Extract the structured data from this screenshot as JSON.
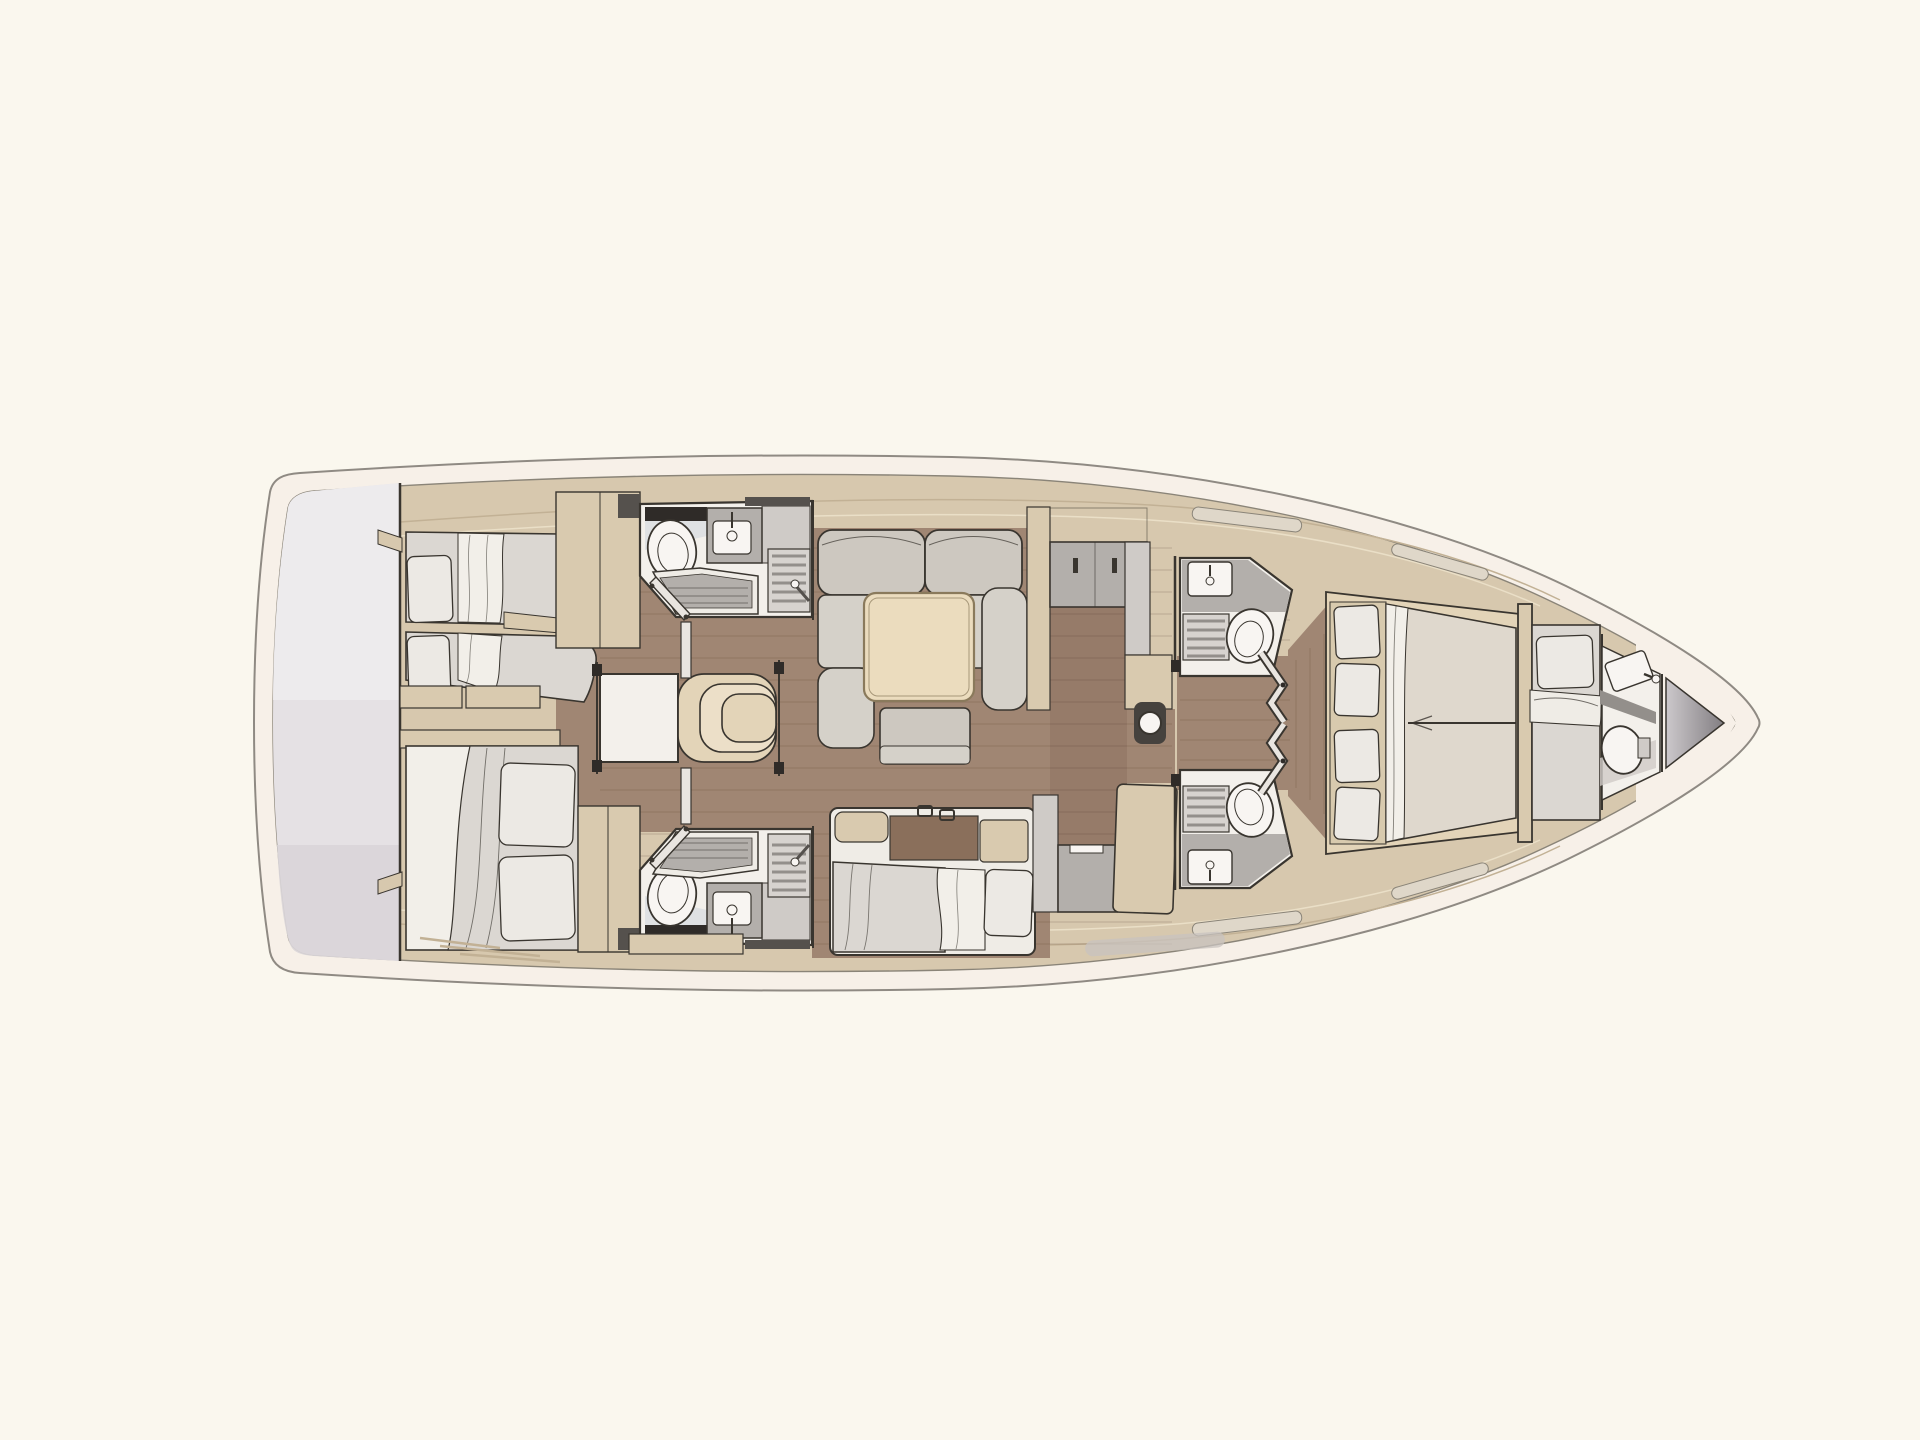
{
  "title": "Sailing yacht interior layout plan — top view (3-cabin / 4-head version)",
  "colors": {
    "bg": "#FAF7EE",
    "hullBand": "#F7F0E8",
    "hullLine": "#8F8A83",
    "deck": "#D7C8AE",
    "deckLine1": "#C2B195",
    "deckLine2": "#EADFC7",
    "deckEdge": "#8A8478",
    "floor": "#A08673",
    "plank": "#5A3E2D",
    "galleyTint": "#50321E",
    "transom": "#E5E1E4",
    "transomHi": "#EFECEE",
    "transomLo": "#D9D5D8",
    "roomWhite": "#F3F0EB",
    "ink": "#39352F",
    "mattress": "#DBD7D2",
    "sheet": "#F2EFE9",
    "duvet": "#EFECE6",
    "pillow": "#ECE9E4",
    "sofa": "#CDC8C0",
    "sofaSeat": "#D5D1C9",
    "tableWood": "#EBDCBE",
    "tableEdge": "#8A7A5C",
    "stepTan": "#E3D4B8",
    "stepTanLight": "#ECDFC8",
    "joinery": "#D9CAAF",
    "joineryDark": "#55514D",
    "counter": "#B3AFAB",
    "counterLight": "#CFCBC7",
    "basin": "#F8F5F2",
    "slat": "#938F8B",
    "grate": "#D7D3CF",
    "darkStrip": "#2F2B28",
    "pale": "#D8DCE0",
    "window": "#DFD7C9",
    "hullWin": "#C8C3BF",
    "anchor1": "#CCC8CB",
    "anchor2": "#827E82",
    "post": "#46423E",
    "doorLeaf": "#E9E5E0",
    "bedMat": "#D8CAAE",
    "fwdMattress": "#DFD8CD",
    "chaiseWood": "#8A6F5B"
  },
  "rooms": [
    {
      "id": "hull",
      "label": "Yacht hull outline, bow to the right"
    },
    {
      "id": "transom",
      "label": "Stern swim platform and transom garage"
    },
    {
      "id": "aft-cabin-port",
      "label": "Aft port cabin with two single berths"
    },
    {
      "id": "aft-cabin-starboard",
      "label": "Aft starboard cabin with double berth"
    },
    {
      "id": "aft-head-port",
      "label": "Aft port bathroom with toilet, washbasin and shower"
    },
    {
      "id": "aft-head-starboard",
      "label": "Aft starboard bathroom with toilet, washbasin and shower"
    },
    {
      "id": "companionway",
      "label": "Companionway landing and curved entry steps"
    },
    {
      "id": "saloon",
      "label": "Saloon with L-shaped sofa, square table and ottoman"
    },
    {
      "id": "settee",
      "label": "Starboard settee berth with pillow"
    },
    {
      "id": "galley",
      "label": "Longitudinal galley with counters, sink and chart table"
    },
    {
      "id": "mast-post",
      "label": "Mast compression post"
    },
    {
      "id": "fwd-head-port",
      "label": "Forward port bathroom with washbasin, shower grate and toilet"
    },
    {
      "id": "fwd-head-starboard",
      "label": "Forward starboard bathroom with washbasin, shower grate and toilet"
    },
    {
      "id": "forward-cabin",
      "label": "Forward cabin with tapered double berth and four pillows"
    },
    {
      "id": "crew-cabin",
      "label": "Bow crew cabin with single berth"
    },
    {
      "id": "bow-head",
      "label": "Bow day head with toilet and washbasin"
    },
    {
      "id": "anchor-locker",
      "label": "Anchor locker at the bow tip"
    }
  ]
}
